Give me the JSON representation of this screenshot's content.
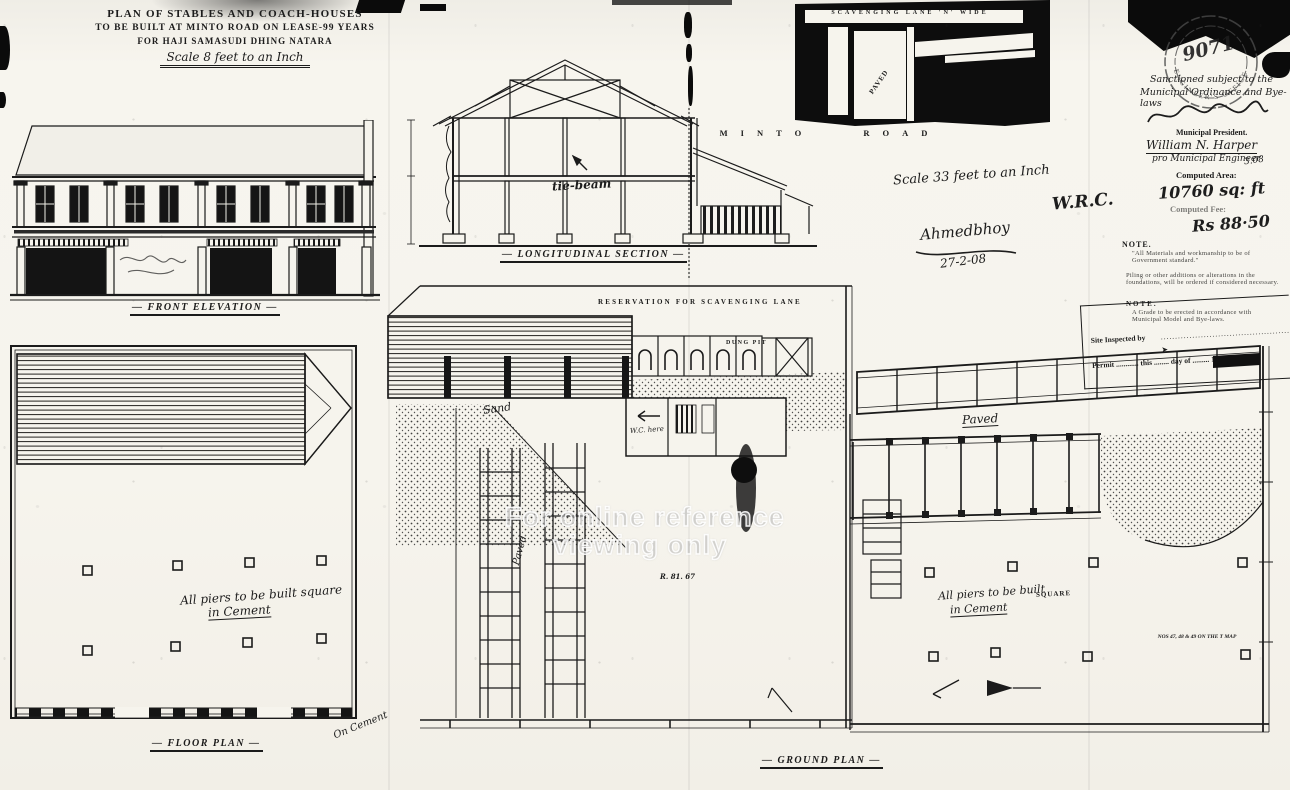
{
  "title": {
    "line1": "PLAN OF STABLES AND COACH-HOUSES",
    "line2": "TO BE BUILT AT MINTO ROAD ON LEASE-99 YEARS",
    "line3": "FOR HAJI SAMASUDI DHING NATARA",
    "scale": "Scale 8 feet to an Inch"
  },
  "labels": {
    "front_elevation": "FRONT ELEVATION",
    "longitudinal_section": "LONGITUDINAL SECTION",
    "floor_plan": "FLOOR PLAN",
    "ground_plan": "GROUND PLAN",
    "minto_road": "MINTO ROAD",
    "reservation": "RESERVATION FOR SCAVENGING LANE",
    "dung_pit": "DUNG PIT",
    "tie_beam": "tie-beam",
    "scavenging_lane": "SCAVENGING LANE 'N' WIDE",
    "paved_diagonal": "PAVED"
  },
  "center_plan": {
    "sand": "Sand",
    "paved": "Paved",
    "plot_ref": "R. 81. 67",
    "wc": "W.C. here"
  },
  "right_plan": {
    "paved": "Paved",
    "piers1": "All piers to be built",
    "piers2": "in Cement",
    "square": "SQUARE",
    "plot_nos": "NOS 47, 48 & 49 ON THE T MAP"
  },
  "left_plan": {
    "piers1": "All piers to be built square",
    "piers2": "in Cement",
    "cement": "On Cement"
  },
  "annotations": {
    "scale33": "Scale 33 feet to an Inch",
    "signature": "Ahmedbhoy",
    "date": "27-2-08",
    "wrc": "W.R.C."
  },
  "margin": {
    "stamp_number": "9071",
    "stamp_ring": "ENGINEER'S OFFICE",
    "sanction1": "Sanctioned subject to the",
    "sanction2": "Municipal Ordinance and Bye-laws",
    "president": "Municipal President.",
    "engineer_sig": "William N. Harper",
    "pro_engineer": "pro Municipal Engineer",
    "pro_date": "3.08",
    "area_label": "Computed Area:",
    "area_value": "10760 sq: ft",
    "fee_label": "Computed Fee:",
    "fee_value": "Rs 88·50",
    "note1_title": "NOTE.",
    "note1_body": "\"All Materials and workmanship to be of Government standard.\"",
    "note2_body": "Piling or other additions or alterations in the foundations, will be ordered if considered necessary.",
    "note3_title": "NOTE.",
    "note3_body": "A Grade to be erected in accordance with Municipal Model and Bye-laws.",
    "site_inspected": "Site Inspected by",
    "site_dots": "................................................",
    "permit_line": "Permit ............ this ........ day of ......... 19......"
  },
  "watermark": {
    "line1": "For online reference",
    "line2": "viewing only"
  },
  "colors": {
    "ink": "#1b1b1b",
    "paper": "#f5f3ec",
    "solid": "#0d0d0d"
  }
}
